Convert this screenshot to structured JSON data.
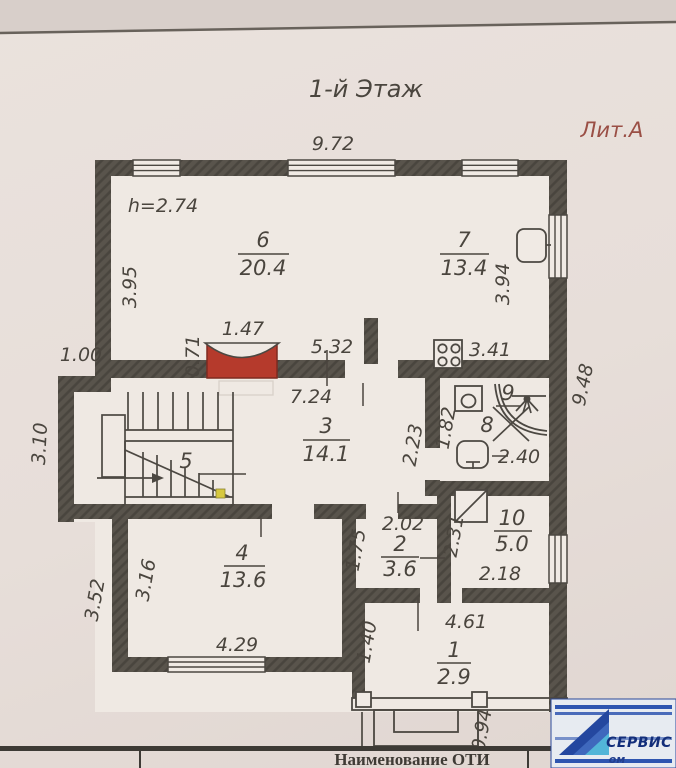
{
  "title": "1-й Этаж",
  "liter": "Лит.А",
  "height_note": "h=2.74",
  "rooms": {
    "r1": {
      "num": "1",
      "area": "2.9"
    },
    "r2": {
      "num": "2",
      "area": "3.6"
    },
    "r3": {
      "num": "3",
      "area": "14.1"
    },
    "r4": {
      "num": "4",
      "area": "13.6"
    },
    "r5": {
      "num": "5",
      "area": ""
    },
    "r6": {
      "num": "6",
      "area": "20.4"
    },
    "r7": {
      "num": "7",
      "area": "13.4"
    },
    "r8": {
      "num": "8",
      "area": ""
    },
    "r9": {
      "num": "9",
      "area": ""
    },
    "r10": {
      "num": "10",
      "area": "5.0"
    }
  },
  "dims": {
    "top_width": "9.72",
    "room6_left": "3.95",
    "room7_right": "3.94",
    "stove_width": "1.47",
    "stove_depth": "0.71",
    "mid_wall": "5.32",
    "kitchen": "3.41",
    "bay_offset": "1.00",
    "right_height": "9.48",
    "bay_height": "3.10",
    "hall_width": "7.24",
    "corridor": "2.23",
    "bath_width": "1.82",
    "bath_length": "2.40",
    "room2_top": "2.02",
    "room2_left": "1.75",
    "room10_left": "2.31",
    "room10_bottom": "2.18",
    "room4_left_inner": "3.16",
    "room4_left_outer": "3.52",
    "room4_bottom": "4.29",
    "room1_left": "1.40",
    "room1_top": "4.61",
    "porch": "0.94"
  },
  "footer": {
    "label": "Наименование ОТИ"
  },
  "logo": {
    "text": "СЕРВИС",
    "sub": "ом"
  },
  "colors": {
    "stove_red": "#b53a2c",
    "liter_red": "#9a4f45",
    "logo_blue": "#24479f",
    "logo_cyan": "#52b5d8"
  }
}
